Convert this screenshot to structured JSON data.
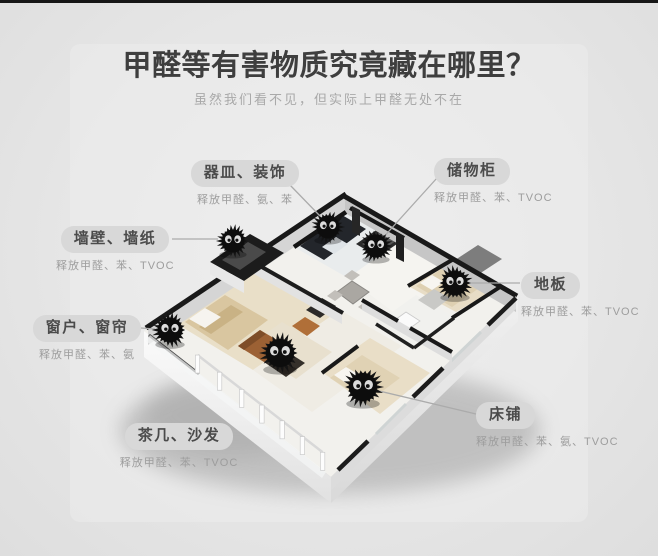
{
  "page": {
    "title": "甲醛等有害物质究竟藏在哪里？",
    "subtitle": "虽然我们看不见，但实际上甲醛无处不在"
  },
  "callouts": [
    {
      "id": "vessels-decorations",
      "label": "器皿、装饰",
      "sub": "释放甲醛、氨、苯"
    },
    {
      "id": "storage-cabinet",
      "label": "储物柜",
      "sub": "释放甲醛、苯、TVOC"
    },
    {
      "id": "walls-wallpaper",
      "label": "墙壁、墙纸",
      "sub": "释放甲醛、苯、TVOC"
    },
    {
      "id": "floor",
      "label": "地板",
      "sub": "释放甲醛、苯、TVOC"
    },
    {
      "id": "windows-curtains",
      "label": "窗户、窗帘",
      "sub": "释放甲醛、苯、氨"
    },
    {
      "id": "tea-table-sofa",
      "label": "茶几、沙发",
      "sub": "释放甲醛、苯、TVOC"
    },
    {
      "id": "bed",
      "label": "床铺",
      "sub": "释放甲醛、苯、氨、TVOC"
    }
  ],
  "colors": {
    "background": "#e6e6e6",
    "background_light": "#ededed",
    "top_bar": "#161616",
    "title_text": "#3e3e3e",
    "subtitle_text": "#a9a9a9",
    "label_pill_bg": "#d8d8d8",
    "label_text": "#4b4b4b",
    "sub_label_text": "#9d9d9d",
    "connector_line": "#ababab",
    "soot_sprite": "#141414"
  }
}
